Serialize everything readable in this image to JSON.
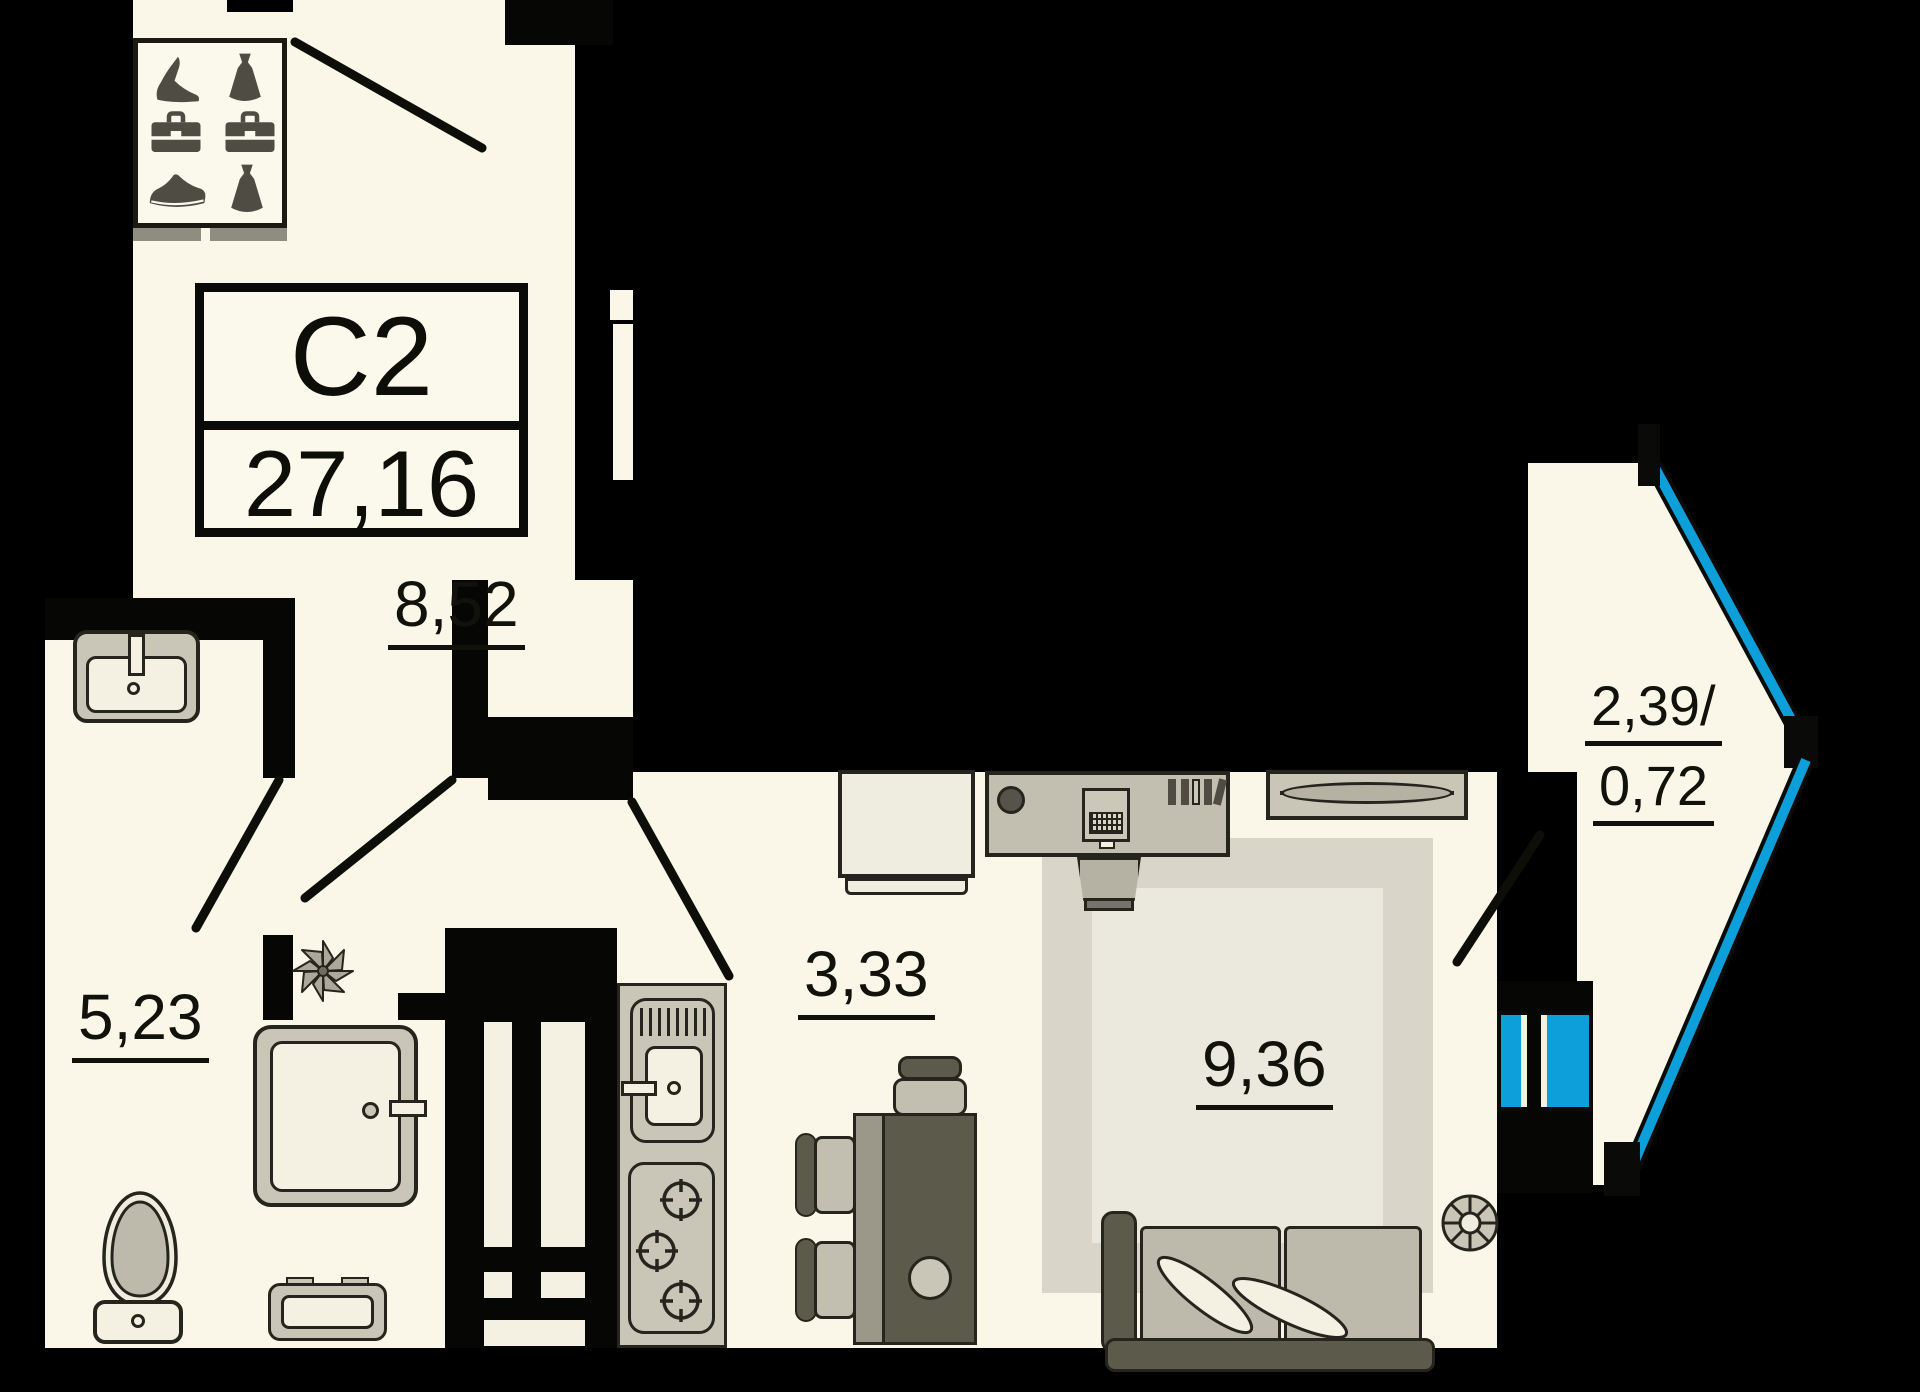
{
  "plan": {
    "unit_label": "С2",
    "total_area": "27,16"
  },
  "rooms": {
    "hallway": {
      "area": "8,52"
    },
    "bathroom": {
      "area": "5,23"
    },
    "kitchen": {
      "area": "3,33"
    },
    "living_room": {
      "area": "9,36"
    },
    "balcony": {
      "area_total": "2,39/",
      "area_coef": "0,72"
    }
  },
  "icons": {
    "wardrobe_icons": [
      "heel-icon",
      "dress-icon",
      "briefcase-icon",
      "briefcase-icon",
      "sneaker-icon",
      "dress-icon"
    ],
    "fixtures": [
      "bathroom-sink",
      "toilet",
      "shower-cabin",
      "bath-mat",
      "plant",
      "kitchen-sink",
      "gas-stove",
      "fridge",
      "desk",
      "laptop",
      "books",
      "office-chair",
      "dining-table",
      "chair",
      "stool",
      "tv-stand",
      "rug",
      "sofa",
      "fan",
      "balcony-door"
    ]
  },
  "colors": {
    "background": "#000000",
    "floor": "#FAF7E8",
    "wall": "#060605",
    "glazing_blue": "#0C9FD9",
    "furniture_gray": "#C9C6B8",
    "furniture_dark": "#5C5A4A",
    "rug_border": "#D9D6C9",
    "rug_fill": "#EBE9DE",
    "text": "#12120C"
  }
}
